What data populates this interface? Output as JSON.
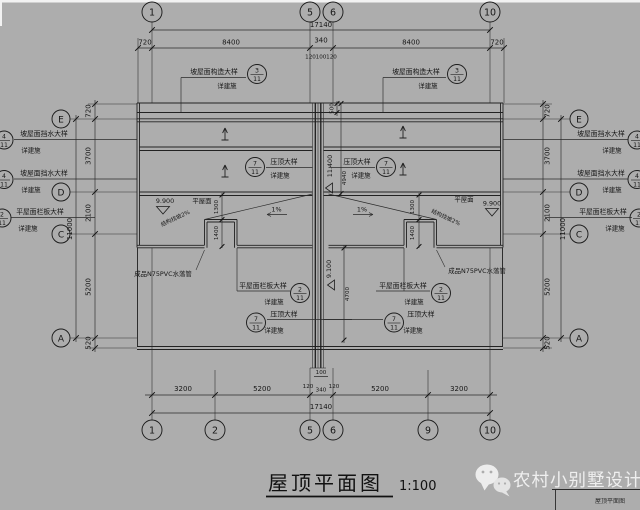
{
  "canvas": {
    "bg": "#adadad",
    "ink": "#1c1c1c",
    "edge_strip": "#f2f2f2"
  },
  "title": {
    "text": "屋顶平面图",
    "scale": "1:100"
  },
  "watermark": {
    "brand": "农村小别墅设计",
    "icon": "wechat-icon",
    "titleblock": "屋顶平面图"
  },
  "axes": {
    "top": [
      "1",
      "5",
      "6",
      "10"
    ],
    "bottom": [
      "1",
      "2",
      "5",
      "6",
      "9",
      "10"
    ],
    "left": [
      "E",
      "D",
      "C",
      "A"
    ],
    "right": [
      "E",
      "D",
      "C",
      "A"
    ]
  },
  "dims": {
    "top": {
      "overall": "17140",
      "seg": [
        "720",
        "8400",
        "340",
        "8400",
        "720"
      ],
      "small": [
        "120",
        "100",
        "120"
      ]
    },
    "bottom": {
      "overall": "17140",
      "seg": [
        "3200",
        "5200",
        "120",
        "340",
        "120",
        "5200",
        "3200"
      ],
      "small": "100"
    },
    "left": {
      "overall": "11000",
      "seg": [
        "720",
        "3700",
        "2100",
        "5200",
        "520"
      ]
    },
    "right": {
      "overall": "11000",
      "seg": [
        "720",
        "3700",
        "2100",
        "5200",
        "520"
      ]
    },
    "inner": {
      "eave": "500",
      "wall_top": "4940",
      "wall_bottom": "4700",
      "step1_l": "1300",
      "step2_l": "1400",
      "step1_r": "1300",
      "step2_r": "1400"
    }
  },
  "levels": {
    "flat_l": "9.900",
    "flat_r": "9.900",
    "ridge": "11.400",
    "terrace": "9.100"
  },
  "notes": {
    "flat_roof_l": "平屋面",
    "flat_roof_r": "平屋面",
    "slope_l": "结构找坡2%",
    "slope_r": "结构找坡2%",
    "grade_l": "1%",
    "grade_r": "1%",
    "pvc_l": "成品N75PVC水落管",
    "pvc_r": "成品N75PVC水落管"
  },
  "callouts": {
    "detail_ref": "详建施",
    "top_l": {
      "text": "坡屋面构造大样",
      "num": "3",
      "den": "11"
    },
    "top_r": {
      "text": "坡屋面构造大样",
      "num": "3",
      "den": "11"
    },
    "left1": {
      "text": "坡屋面挡水大样",
      "num": "4",
      "den": "11"
    },
    "left2": {
      "text": "坡屋面挡水大样",
      "num": "4",
      "den": "11"
    },
    "left3": {
      "text": "平屋面栏板大样",
      "num": "2",
      "den": "11"
    },
    "right1": {
      "text": "坡屋面挡水大样",
      "num": "4",
      "den": "11"
    },
    "right2": {
      "text": "坡屋面挡水大样",
      "num": "4",
      "den": "11"
    },
    "right3": {
      "text": "平屋面栏板大样",
      "num": "2",
      "den": "11"
    },
    "mid_l": {
      "text": "压顶大样",
      "num": "7",
      "den": "11"
    },
    "mid_r": {
      "text": "压顶大样",
      "num": "7",
      "den": "11"
    },
    "bot_l1": {
      "text": "平屋面栏板大样",
      "num": "2",
      "den": "11"
    },
    "bot_l2": {
      "text": "压顶大样",
      "num": "7",
      "den": "11"
    },
    "bot_r1": {
      "text": "平屋面栏板大样",
      "num": "2",
      "den": "11"
    },
    "bot_r2": {
      "text": "压顶大样",
      "num": "7",
      "den": "11"
    }
  }
}
